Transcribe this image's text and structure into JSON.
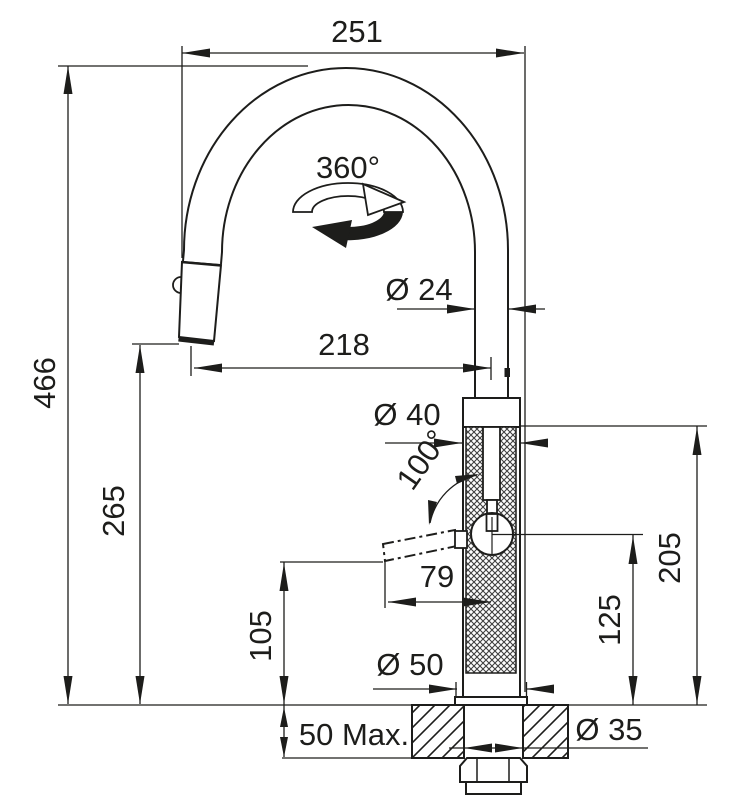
{
  "drawing": {
    "type": "faucet-installation-dimension-drawing",
    "units_shown": "mm (unlabeled numeric dimensions)",
    "colors": {
      "line": "#1d1d1b",
      "background": "#ffffff"
    },
    "dimensions": {
      "spout_width": "251",
      "total_height": "466",
      "outlet_height": "265",
      "swivel_angle": "360°",
      "spout_pipe_diameter": "Ø 24",
      "spout_reach": "218",
      "body_diameter": "Ø 40",
      "handle_swing_angle": "100°",
      "handle_length": "79",
      "handle_height": "105",
      "valve_center_height": "125",
      "body_top_height": "205",
      "base_diameter": "Ø 50",
      "max_counter_thickness": "50 Max.",
      "hole_diameter": "Ø 35"
    }
  }
}
